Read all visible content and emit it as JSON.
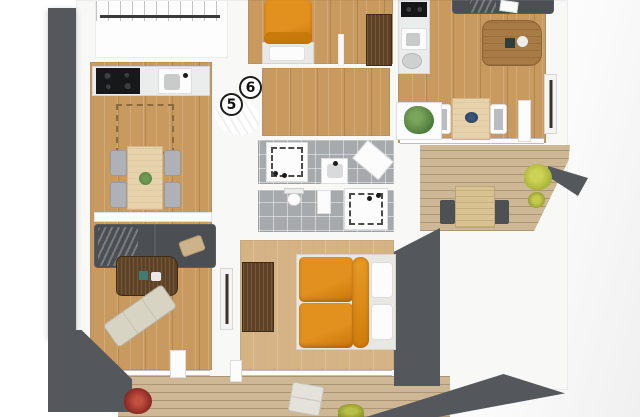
{
  "units": {
    "five": "5",
    "six": "6"
  },
  "colors": {
    "wall_dark": "#54575b",
    "wall_light": "#f8f8f7",
    "wood": "#c89a5f",
    "wood_light": "#d6b384",
    "deck": "#cdb795",
    "tile": "#a6aaad",
    "orange": "#e2901e",
    "orange_deep": "#c67708",
    "teal": "#84b4a2",
    "sofa": "#4b4f54",
    "walnut": "#5d4226",
    "table_light": "#e7d3ab",
    "chair_gray": "#aeb2b6",
    "plant_green": "#4f7d3a",
    "plant_yellow": "#a8b43a",
    "plant_red": "#96302a"
  }
}
